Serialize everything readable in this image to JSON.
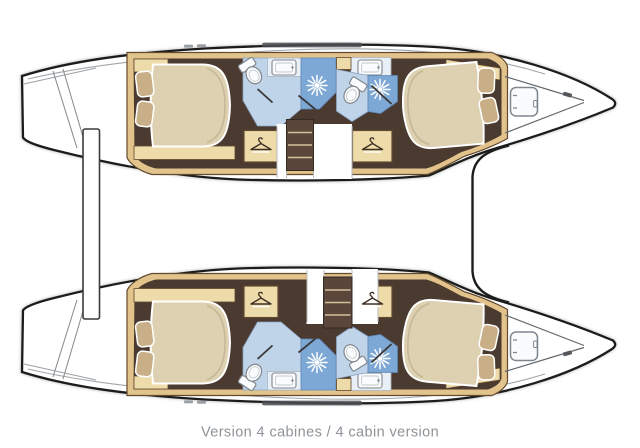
{
  "caption": {
    "text": "Version 4 cabines / 4 cabin version"
  },
  "palette": {
    "background": "#ffffff",
    "hull-fill": "#ffffff",
    "hull-outline": "#1d1d1b",
    "deck-line": "#a0a5aa",
    "roof-strip": "#4a4e52",
    "wood": "#e2c38c",
    "wood-light": "#eedbaa",
    "wood-border": "#63492f",
    "floor": "#4b3a2f",
    "steps": "#5a463a",
    "step-edge": "#d3c19c",
    "bed": "#ddd1b2",
    "bed-shade": "#c6b897",
    "pillow": "#c8af88",
    "bath-floor": "#c0d4e9",
    "bath-panel": "#e8eff6",
    "shower": "#7da7d5",
    "shower-ray": "#ffffff",
    "fixture": "#fafbfc",
    "fixture-stroke": "#7e868d",
    "screen-line": "#3a3a38",
    "gap-edge": "#b7bbbf",
    "caption": "#8d9398"
  },
  "icons": {
    "wardrobe-hanger": "clothes-hanger glyph",
    "shower-head": "white starburst spray",
    "toilet": "oval bowl with cistern",
    "sink": "rounded rectangle basin",
    "deck-hatch": "rounded square with hinge ticks",
    "companionway-steps": "stacked dark treads"
  }
}
